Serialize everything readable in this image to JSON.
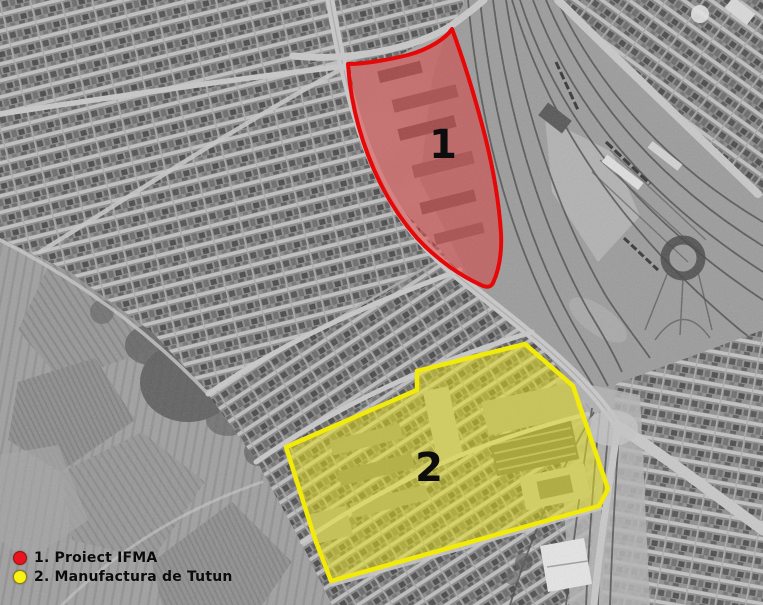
{
  "map": {
    "regions": [
      {
        "number": "1",
        "name": "Proiect IFMA",
        "outline_color": "#e60808",
        "fill_color": "rgba(231,44,44,0.44)"
      },
      {
        "number": "2",
        "name": "Manufactura de Tutun",
        "outline_color": "#f2ea08",
        "fill_color": "rgba(235,228,24,0.5)"
      }
    ]
  },
  "legend": {
    "items": [
      {
        "marker_color": "#ea1420",
        "label": "1. Proiect IFMA"
      },
      {
        "marker_color": "#f8f215",
        "label": "2. Manufactura de Tutun"
      }
    ]
  }
}
